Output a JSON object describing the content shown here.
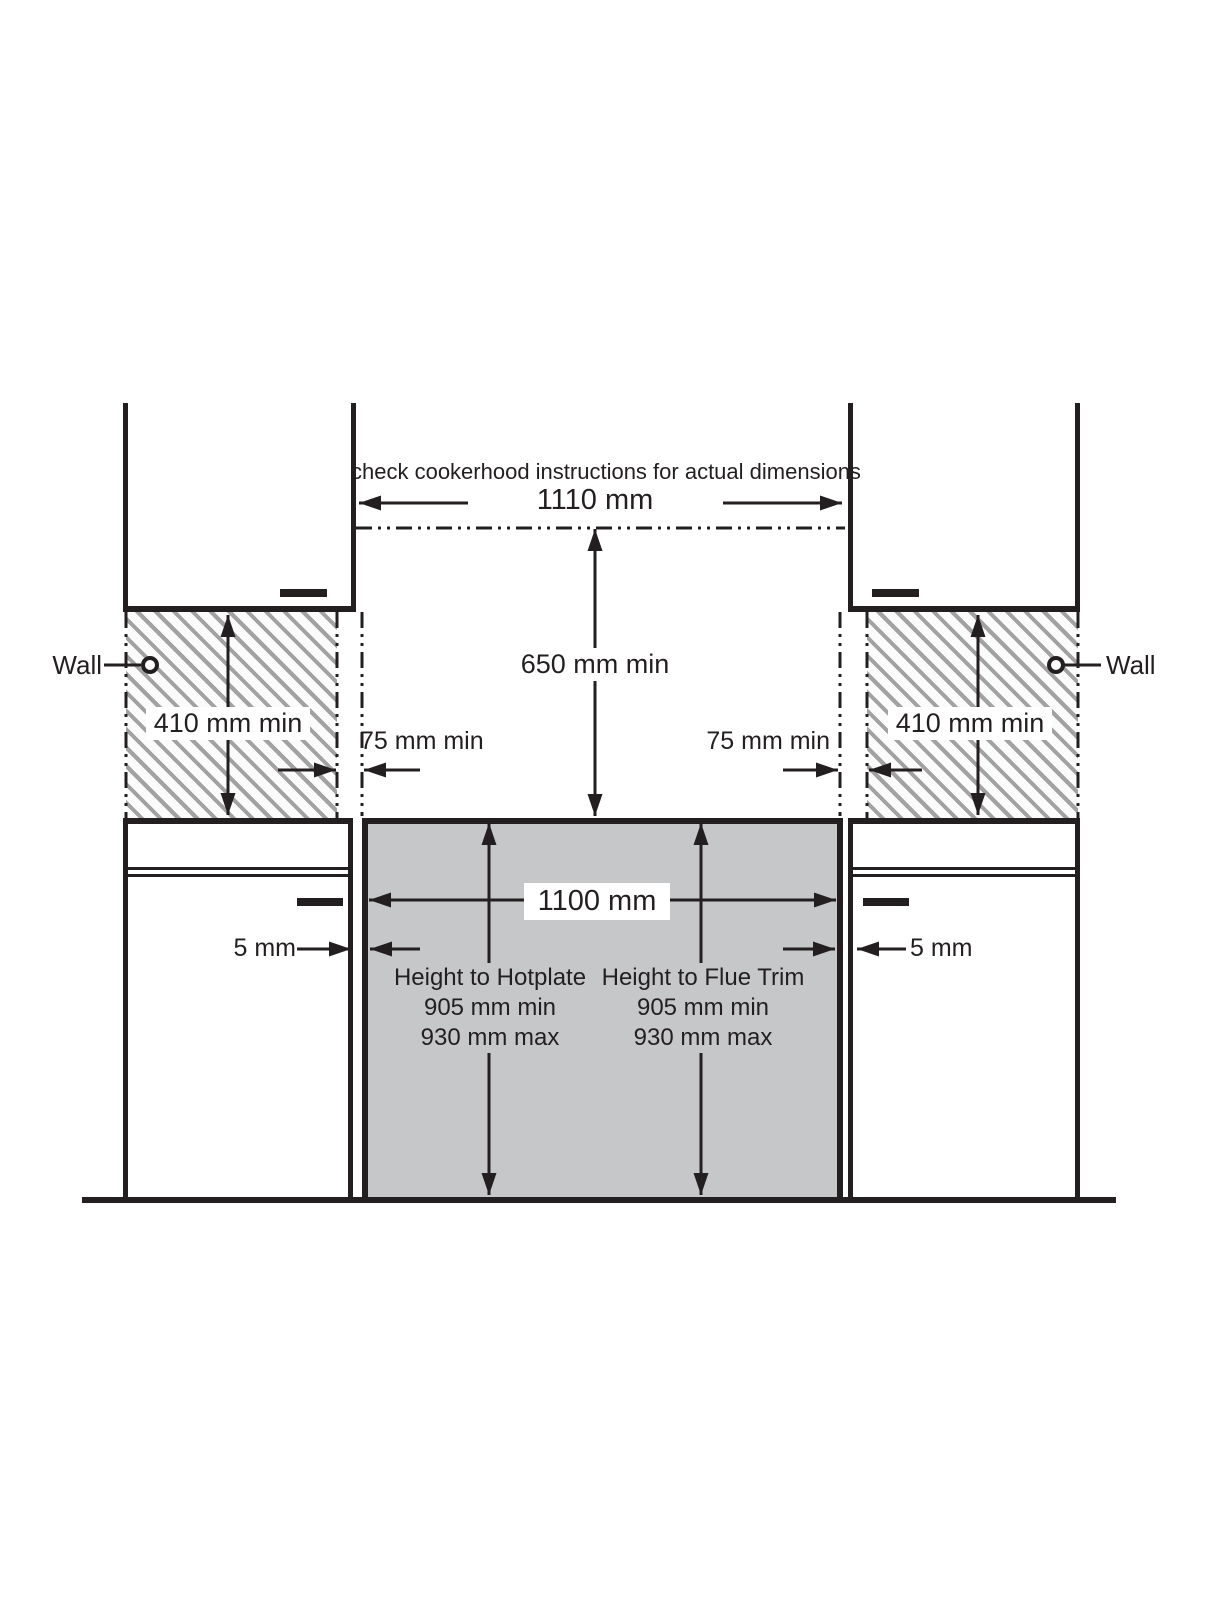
{
  "diagram": {
    "note": "check cookerhood instructions for actual dimensions",
    "labels": {
      "wall_left": "Wall",
      "wall_right": "Wall"
    },
    "dims": {
      "hood_width": "1110 mm",
      "hood_clearance": "650 mm min",
      "wall_height_left": "410 mm min",
      "wall_height_right": "410 mm min",
      "side_clearance_left": "75 mm min",
      "side_clearance_right": "75 mm min",
      "cooker_width": "1100 mm",
      "gap_left": "5 mm",
      "gap_right": "5 mm"
    },
    "hotplate": {
      "title": "Height to Hotplate",
      "min": "905 mm min",
      "max": "930 mm max"
    },
    "flue": {
      "title": "Height to Flue Trim",
      "min": "905 mm min",
      "max": "930 mm max"
    },
    "colors": {
      "line": "#231f20",
      "cooker_fill": "#c6c7c9",
      "hatch_stripe": "#a2a2a2",
      "background": "#ffffff"
    }
  }
}
